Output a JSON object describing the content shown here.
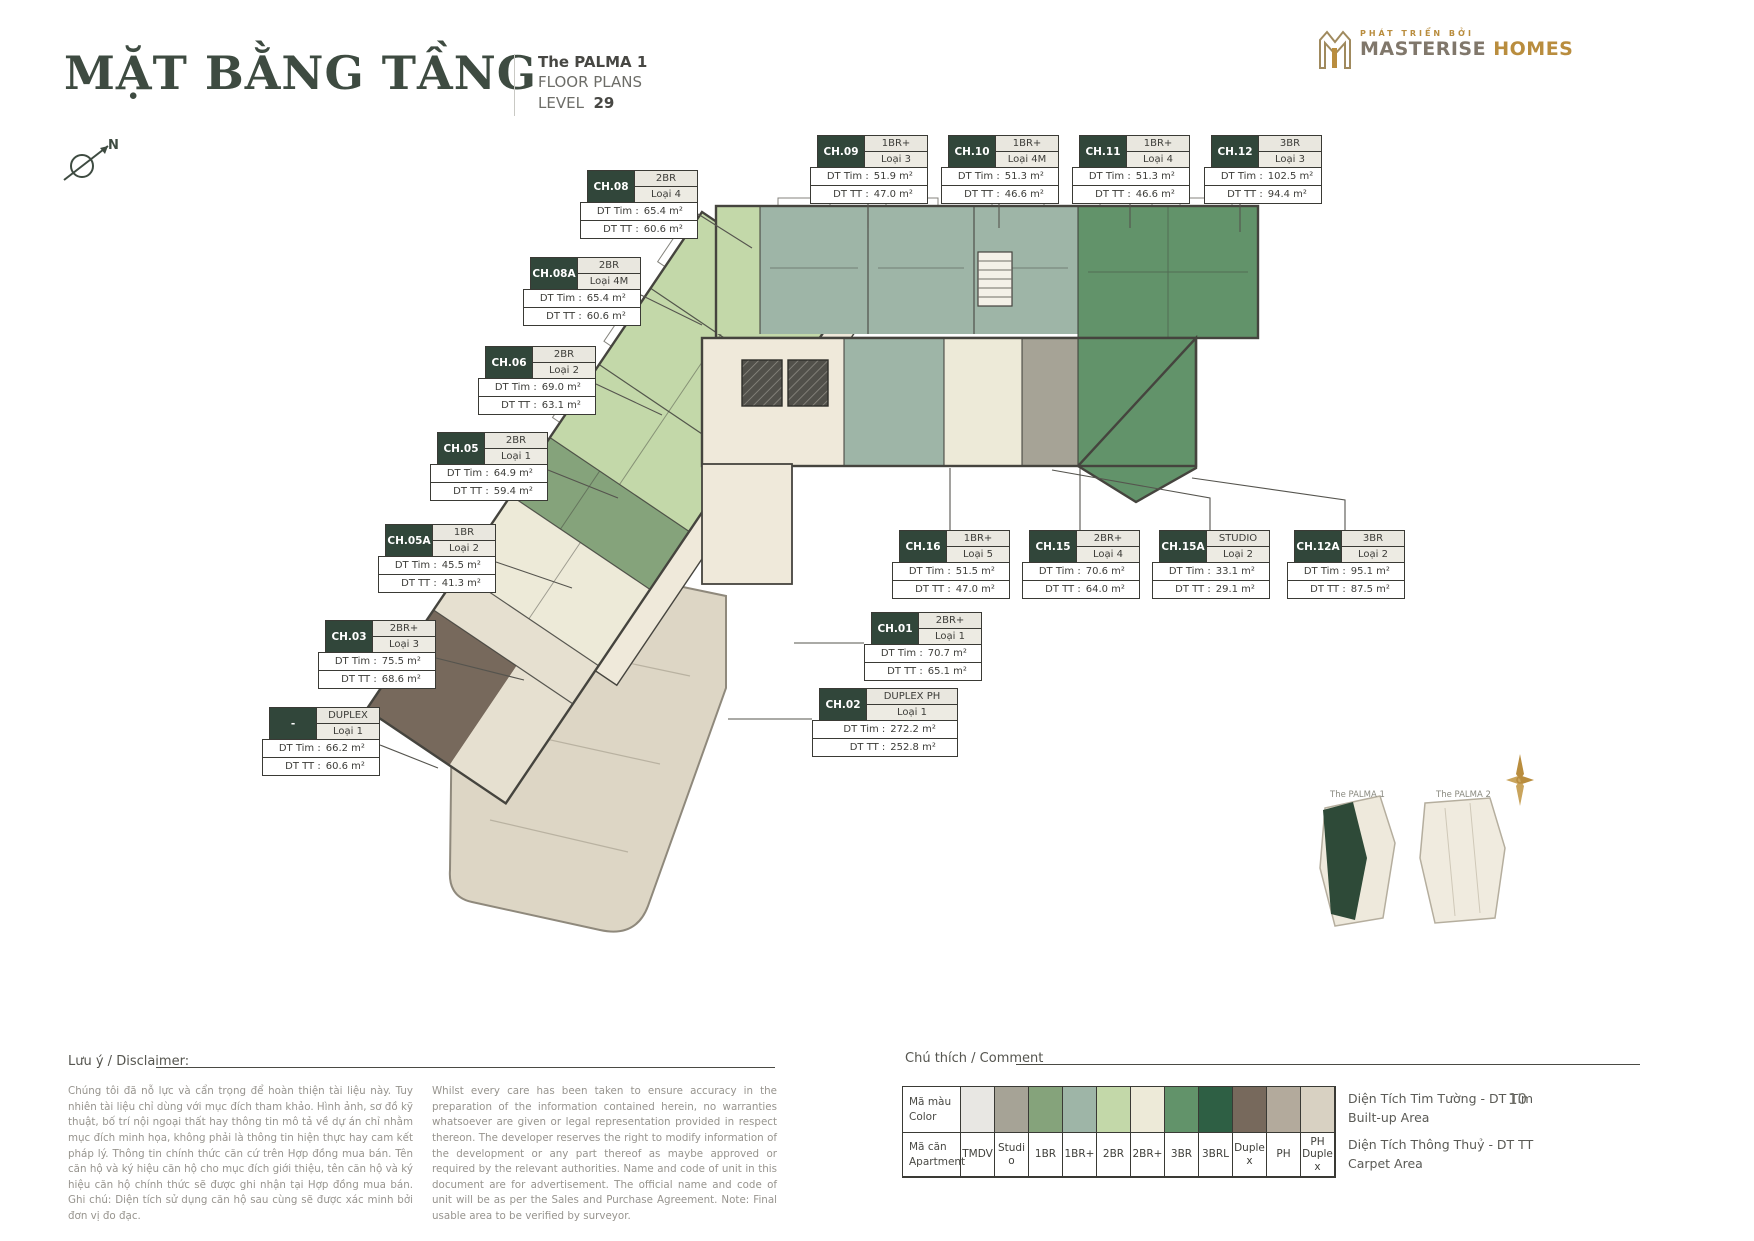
{
  "header": {
    "title": "MẶT BẰNG TẦNG",
    "project": "The PALMA  1",
    "subtitle": "FLOOR PLANS",
    "level_label": "LEVEL",
    "level_value": "29",
    "brand_tagline": "PHÁT TRIỂN BỞI",
    "brand_primary": "MASTERISE",
    "brand_secondary": "HOMES"
  },
  "compass": {
    "north_label": "N"
  },
  "labels": {
    "tim": "DT Tim :",
    "tt": "DT TT :"
  },
  "units": [
    {
      "code": "CH.08",
      "type": "2BR",
      "variant": "Loại 4",
      "dt_tim": "65.4 m²",
      "dt_tt": "60.6 m²"
    },
    {
      "code": "CH.08A",
      "type": "2BR",
      "variant": "Loại 4M",
      "dt_tim": "65.4 m²",
      "dt_tt": "60.6 m²"
    },
    {
      "code": "CH.06",
      "type": "2BR",
      "variant": "Loại 2",
      "dt_tim": "69.0 m²",
      "dt_tt": "63.1 m²"
    },
    {
      "code": "CH.05",
      "type": "2BR",
      "variant": "Loại 1",
      "dt_tim": "64.9 m²",
      "dt_tt": "59.4 m²"
    },
    {
      "code": "CH.05A",
      "type": "1BR",
      "variant": "Loại 2",
      "dt_tim": "45.5 m²",
      "dt_tt": "41.3 m²"
    },
    {
      "code": "CH.03",
      "type": "2BR+",
      "variant": "Loại 3",
      "dt_tim": "75.5 m²",
      "dt_tt": "68.6 m²"
    },
    {
      "code": "-",
      "type": "DUPLEX",
      "variant": "Loại 1",
      "dt_tim": "66.2 m²",
      "dt_tt": "60.6 m²"
    },
    {
      "code": "CH.09",
      "type": "1BR+",
      "variant": "Loại 3",
      "dt_tim": "51.9 m²",
      "dt_tt": "47.0 m²"
    },
    {
      "code": "CH.10",
      "type": "1BR+",
      "variant": "Loại 4M",
      "dt_tim": "51.3 m²",
      "dt_tt": "46.6 m²"
    },
    {
      "code": "CH.11",
      "type": "1BR+",
      "variant": "Loại 4",
      "dt_tim": "51.3 m²",
      "dt_tt": "46.6 m²"
    },
    {
      "code": "CH.12",
      "type": "3BR",
      "variant": "Loại 3",
      "dt_tim": "102.5 m²",
      "dt_tt": "94.4 m²"
    },
    {
      "code": "CH.16",
      "type": "1BR+",
      "variant": "Loại 5",
      "dt_tim": "51.5 m²",
      "dt_tt": "47.0 m²"
    },
    {
      "code": "CH.15",
      "type": "2BR+",
      "variant": "Loại 4",
      "dt_tim": "70.6 m²",
      "dt_tt": "64.0 m²"
    },
    {
      "code": "CH.15A",
      "type": "STUDIO",
      "variant": "Loại 2",
      "dt_tim": "33.1 m²",
      "dt_tt": "29.1 m²"
    },
    {
      "code": "CH.12A",
      "type": "3BR",
      "variant": "Loại 2",
      "dt_tim": "95.1 m²",
      "dt_tt": "87.5 m²"
    },
    {
      "code": "CH.01",
      "type": "2BR+",
      "variant": "Loại 1",
      "dt_tim": "70.7 m²",
      "dt_tt": "65.1 m²"
    },
    {
      "code": "CH.02",
      "type": "DUPLEX PH",
      "variant": "Loại 1",
      "dt_tim": "272.2 m²",
      "dt_tt": "252.8 m²"
    }
  ],
  "site_map": {
    "palma1": "The PALMA 1",
    "palma2": "The PALMA 2"
  },
  "disclaimer": {
    "heading": "Lưu ý / Disclaimer:",
    "vi": "Chúng tôi đã nỗ lực và cẩn trọng để hoàn thiện tài liệu này. Tuy nhiên tài liệu chỉ dùng với mục đích tham khảo. Hình ảnh, sơ đồ kỹ thuật, bố trí nội ngoại thất hay thông tin mô tả về dự án chỉ nhằm mục đích minh họa, không phải là thông tin hiện thực hay cam kết pháp lý. Thông tin chính thức căn cứ trên Hợp đồng mua bán. Tên căn hộ và ký hiệu căn hộ cho mục đích giới thiệu, tên căn hộ và ký hiệu căn hộ chính thức sẽ được ghi nhận tại Hợp đồng mua bán. Ghi chú: Diện tích sử dụng căn hộ sau cùng sẽ được xác minh bởi đơn vị đo đạc.",
    "en": "Whilst every care has been taken to ensure accuracy in the preparation of the information contained herein, no warranties whatsoever are given or legal representation provided in respect thereon. The developer reserves the right to modify information of the development or any part thereof as maybe approved or required by the relevant authorities. Name and code of unit in this document are for advertisement. The official name and code of unit will be as per the Sales and Purchase Agreement. Note: Final usable area to be verified by surveyor."
  },
  "legend": {
    "heading": "Chú thích / Comment",
    "row1_vi": "Mã màu",
    "row1_en": "Color",
    "row2_vi": "Mã căn",
    "row2_en": "Apartment",
    "items": [
      {
        "label": "TMDV",
        "color": "#e8e7e3"
      },
      {
        "label": "Studio",
        "color": "#a6a396"
      },
      {
        "label": "1BR",
        "color": "#85a37b"
      },
      {
        "label": "1BR+",
        "color": "#9eb5a7"
      },
      {
        "label": "2BR",
        "color": "#c3d8a9"
      },
      {
        "label": "2BR+",
        "color": "#edead8"
      },
      {
        "label": "3BR",
        "color": "#62936a"
      },
      {
        "label": "3BRL",
        "color": "#2e5f44"
      },
      {
        "label": "Duplex",
        "color": "#77695c"
      },
      {
        "label": "PH",
        "color": "#b3aa9c"
      },
      {
        "label": "PH Duplex",
        "color": "#d8d1c2"
      }
    ],
    "note_builtup_vi": "Diện Tích Tim Tường - DT Tim",
    "note_builtup_en": "Built-up Area",
    "note_carpet_vi": "Diện Tích Thông Thuỷ - DT TT",
    "note_carpet_en": "Carpet Area"
  },
  "page_number": "10"
}
